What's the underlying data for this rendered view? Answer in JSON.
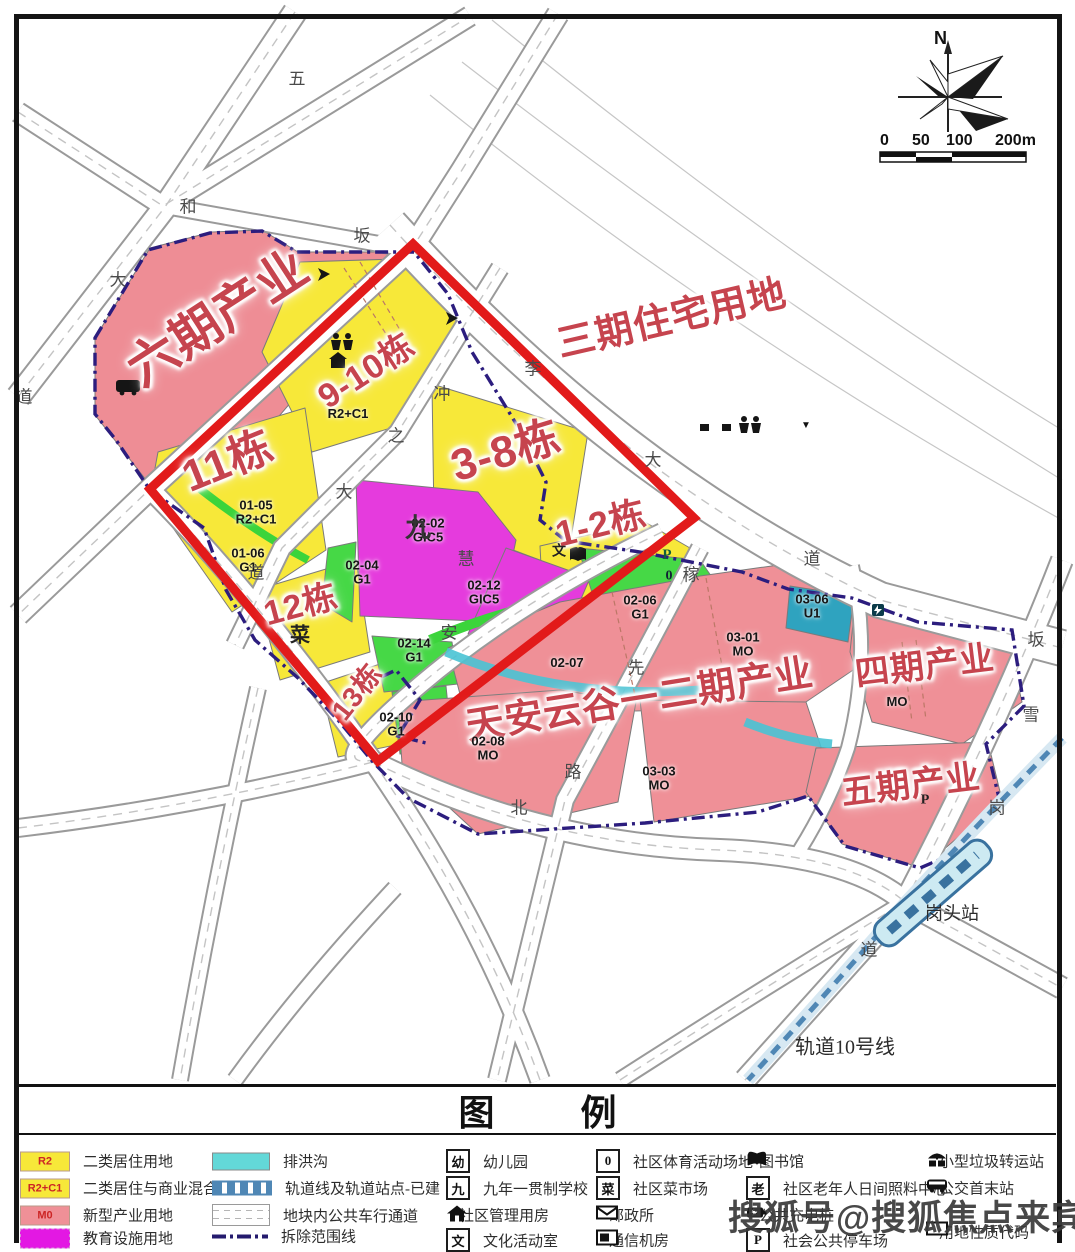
{
  "compass": {
    "north": "N"
  },
  "scalebar": {
    "t0": "0",
    "t1": "50",
    "t2": "100",
    "t3": "200m"
  },
  "areas": {
    "phase6": "六期产业",
    "phase3": "三期住宅用地",
    "phase12": "天安云谷一二期产业",
    "phase4": "四期产业",
    "phase5": "五期产业",
    "b9_10": "9-10栋",
    "b11": "11栋",
    "b3_8": "3-8栋",
    "b1_2": "1-2栋",
    "b12": "12栋",
    "b13": "13栋"
  },
  "parcels": {
    "p01_05": {
      "code": "01-05",
      "use": "R2+C1"
    },
    "p01_06": {
      "code": "01-06",
      "use": "G1"
    },
    "r2c1": {
      "code": "R2+C1",
      "use": ""
    },
    "p02_02": {
      "code": "02-02",
      "use": "GIC5"
    },
    "p02_04": {
      "code": "02-04",
      "use": "G1"
    },
    "p02_12": {
      "code": "02-12",
      "use": "GIC5"
    },
    "p02_14": {
      "code": "02-14",
      "use": "G1"
    },
    "p02_10": {
      "code": "02-10",
      "use": "G1"
    },
    "p02_06": {
      "code": "02-06",
      "use": "G1"
    },
    "p02_07": {
      "code": "02-07",
      "use": ""
    },
    "p02_08": {
      "code": "02-08",
      "use": "MO"
    },
    "p03_03": {
      "code": "03-03",
      "use": "MO"
    },
    "p03_01": {
      "code": "03-01",
      "use": "MO"
    },
    "p03_06": {
      "code": "03-06",
      "use": "U1"
    },
    "p04mo": {
      "code": "MO",
      "use": ""
    }
  },
  "road_chars": [
    {
      "ch": "五"
    },
    {
      "ch": "和"
    },
    {
      "ch": "大"
    },
    {
      "ch": "道"
    },
    {
      "ch": "坂"
    },
    {
      "ch": "李"
    },
    {
      "ch": "冲"
    },
    {
      "ch": "之"
    },
    {
      "ch": "大"
    },
    {
      "ch": "道"
    },
    {
      "ch": "大"
    },
    {
      "ch": "道"
    },
    {
      "ch": "慧"
    },
    {
      "ch": "安"
    },
    {
      "ch": "稼"
    },
    {
      "ch": "先"
    },
    {
      "ch": "路"
    },
    {
      "ch": "北"
    },
    {
      "ch": "坂"
    },
    {
      "ch": "雪"
    },
    {
      "ch": "岗"
    },
    {
      "ch": "道"
    }
  ],
  "map_marks": {
    "school": "九",
    "market": "菜",
    "culture": "文",
    "parking": "P",
    "sports": "0",
    "tri": "▼",
    "parking2": "P"
  },
  "metro": {
    "line": "轨道10号线",
    "station": "岗头站"
  },
  "legend": {
    "title": "图 例",
    "col1": [
      {
        "key": "R2",
        "label": "二类居住用地"
      },
      {
        "key": "R2+C1",
        "label": "二类居住与商业混合用地"
      },
      {
        "key": "M0",
        "label": "新型产业用地"
      },
      {
        "key": "",
        "label": "教育设施用地"
      }
    ],
    "col2": [
      {
        "label": "排洪沟"
      },
      {
        "label": "轨道线及轨道站点-已建"
      },
      {
        "label": "地块内公共车行通道"
      },
      {
        "label": "拆除范围线"
      }
    ],
    "col3": [
      {
        "glyph": "幼",
        "label": "幼儿园"
      },
      {
        "glyph": "九",
        "label": "九年一贯制学校"
      },
      {
        "glyph": "",
        "label": "社区管理用房"
      },
      {
        "glyph": "文",
        "label": "文化活动室"
      }
    ],
    "col4": [
      {
        "glyph": "0",
        "label": "社区体育活动场地"
      },
      {
        "glyph": "菜",
        "label": "社区菜市场"
      },
      {
        "glyph": "",
        "label": "邮政所"
      },
      {
        "glyph": "",
        "label": "通信机房"
      }
    ],
    "col5": [
      {
        "glyph": "",
        "label": "图书馆"
      },
      {
        "glyph": "老",
        "label": "社区老年人日间照料中心"
      },
      {
        "glyph": "",
        "label": "公共充电桩"
      },
      {
        "glyph": "P",
        "label": "社会公共停车场"
      }
    ],
    "col6": [
      {
        "glyph": "",
        "label": "小型垃圾转运站"
      },
      {
        "glyph": "",
        "label": "公交首末站"
      },
      {
        "glyph": "",
        "label": "用地性质代码"
      }
    ]
  },
  "watermark": "搜狐号@搜狐焦点来宾站"
}
